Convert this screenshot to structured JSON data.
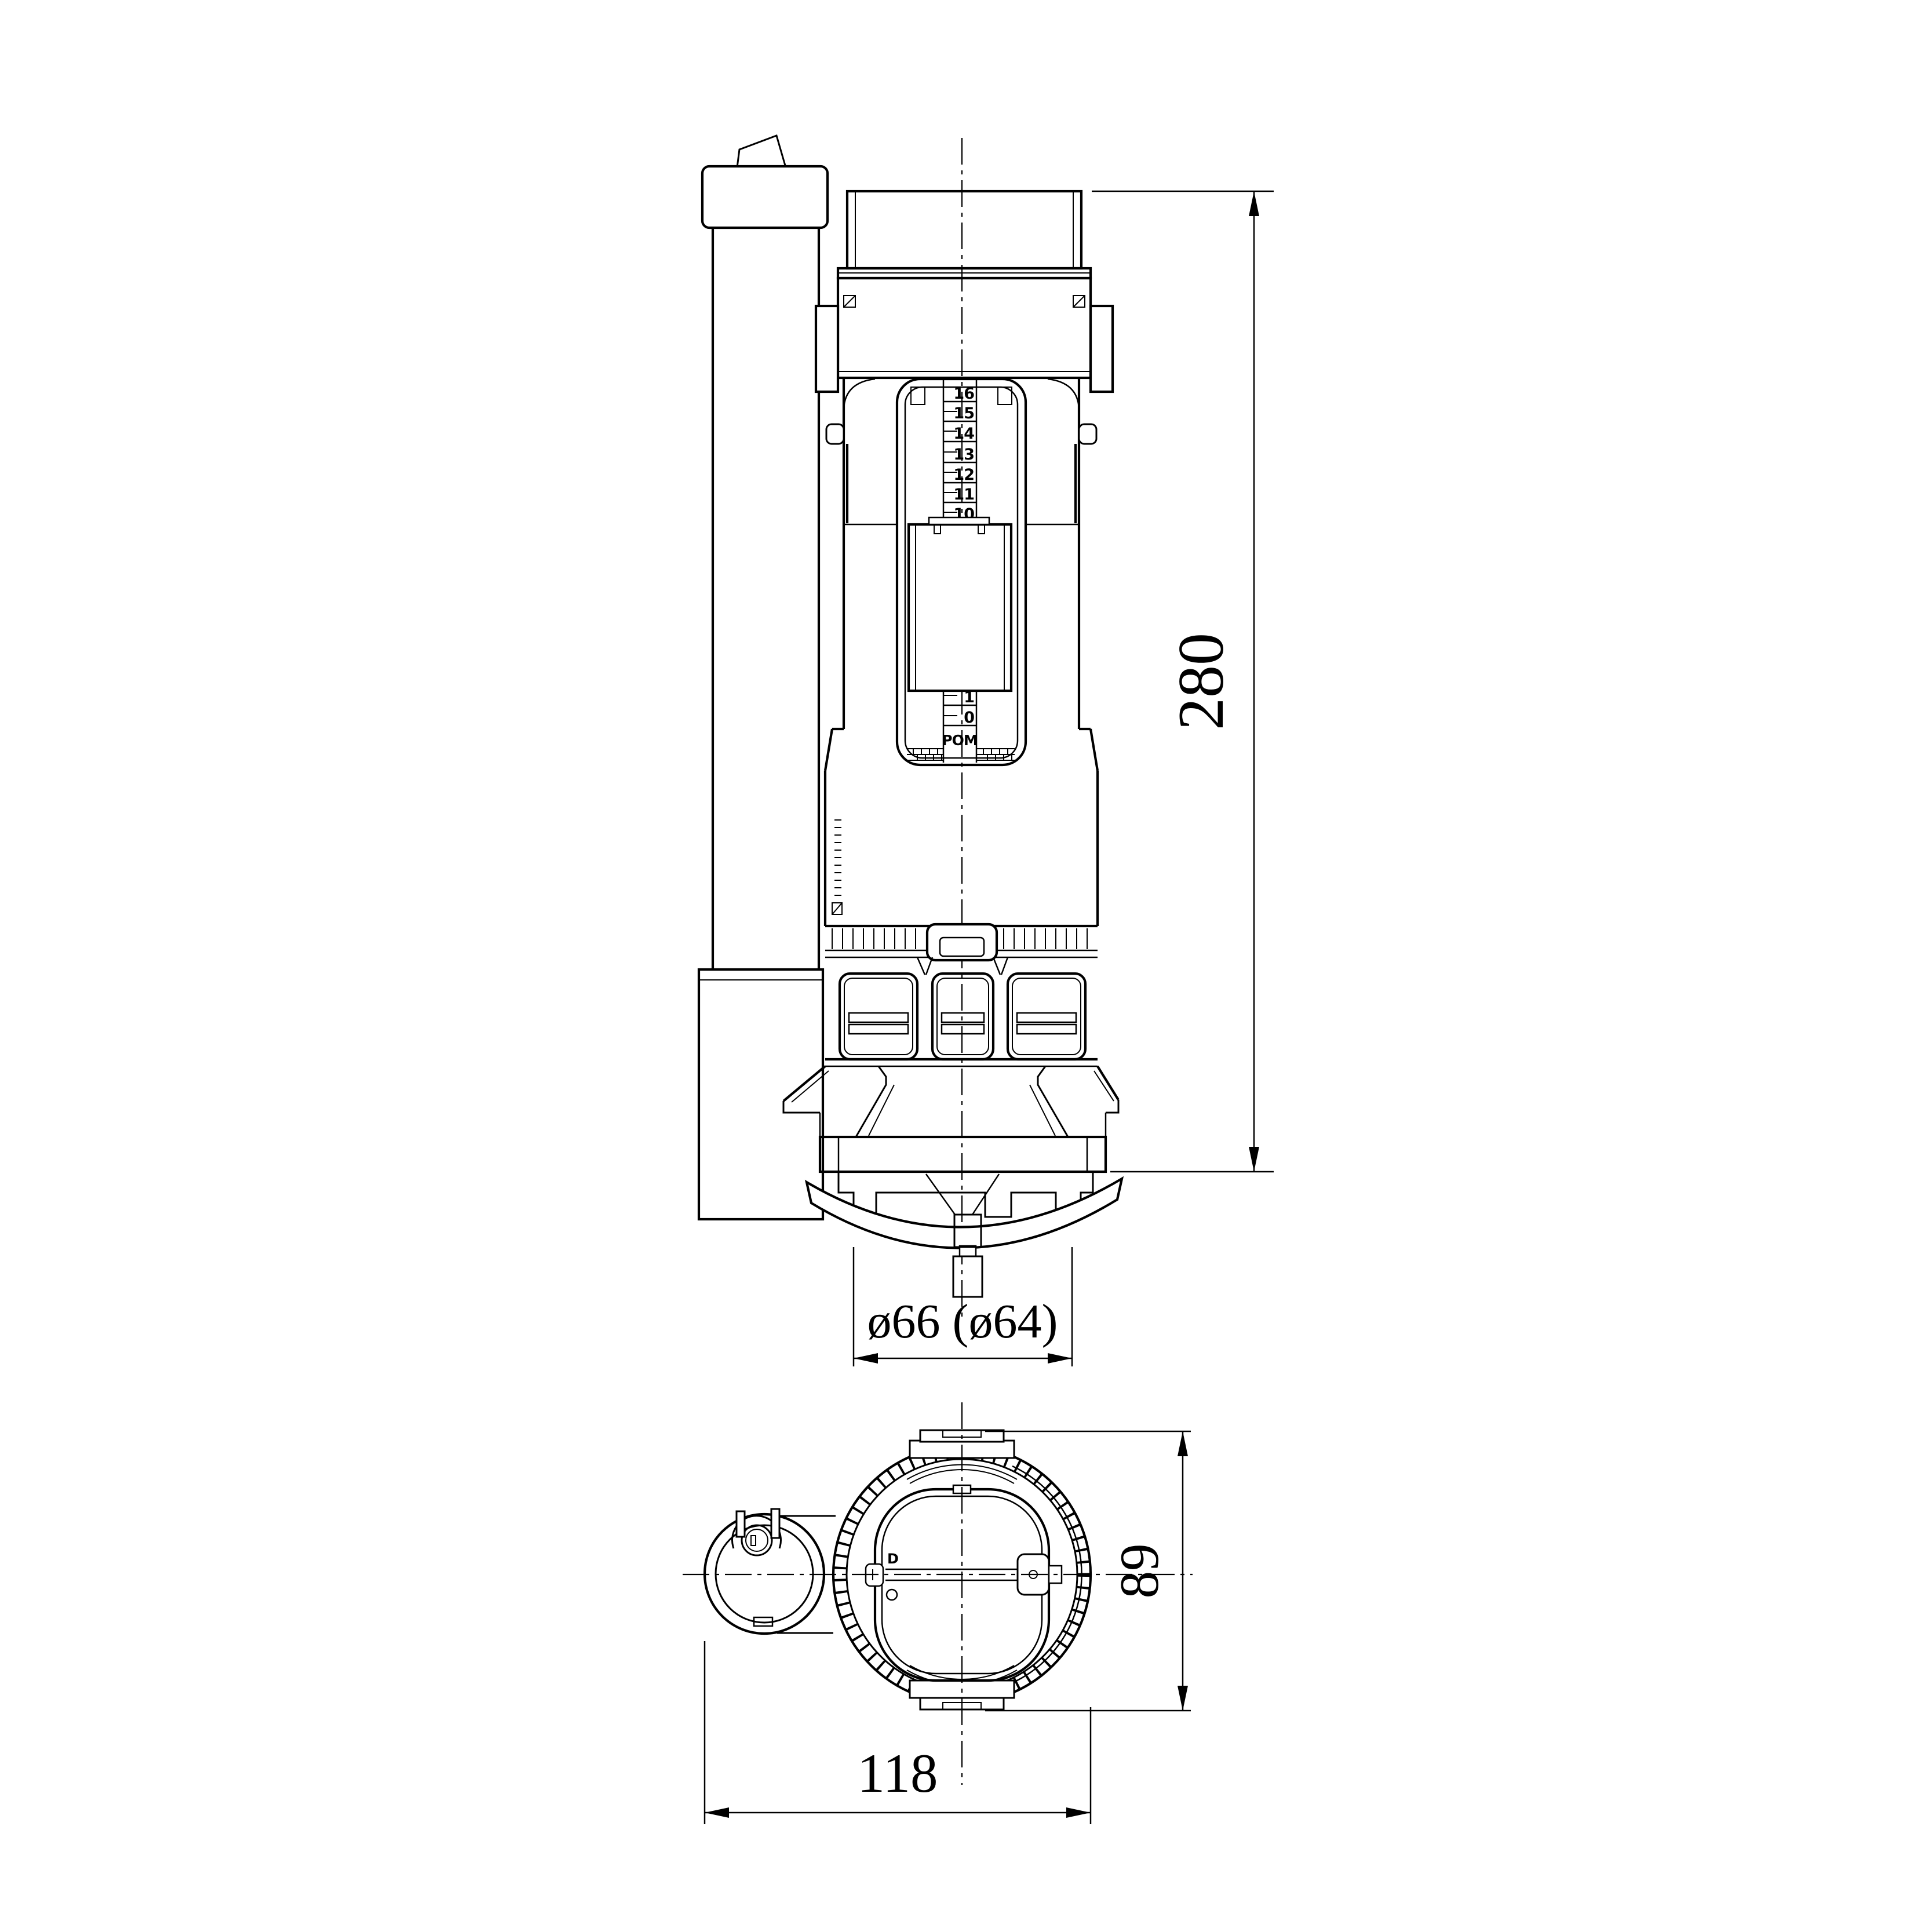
{
  "sheet": {
    "background": "#ffffff",
    "line_color": "#000000",
    "content": "technical drawing of dual-flush toilet flush valve, front elevation and bottom view"
  },
  "front_view": {
    "dim_height": "280",
    "dim_outlet": "ø66 (ø64)",
    "scale_upper": [
      "16",
      "15",
      "14",
      "13",
      "12",
      "11",
      "10"
    ],
    "scale_lower": [
      "1",
      "0"
    ],
    "material_label": "POM"
  },
  "bottom_view": {
    "dim_width": "118",
    "dim_depth": "89",
    "mark_letter": "D"
  }
}
